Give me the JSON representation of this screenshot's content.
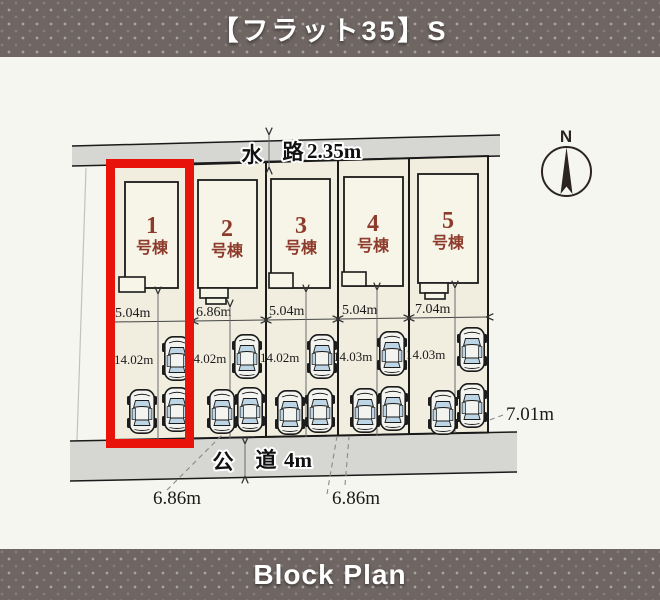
{
  "header": {
    "title": "【フラット35】S"
  },
  "footer": {
    "title": "Block Plan"
  },
  "compass": {
    "north_label": "N"
  },
  "waterway": {
    "label_left": "水",
    "label_right": "路",
    "dimension": "2.35m"
  },
  "road": {
    "label_left": "公",
    "label_right": "道",
    "dimension": "4m"
  },
  "lots": [
    {
      "number": "1",
      "suffix": "号棟",
      "width": "5.04m",
      "depth": "14.02m",
      "highlighted": true
    },
    {
      "number": "2",
      "suffix": "号棟",
      "width": "6.86m",
      "depth": "14.02m",
      "highlighted": false
    },
    {
      "number": "3",
      "suffix": "号棟",
      "width": "5.04m",
      "depth": "14.02m",
      "highlighted": false
    },
    {
      "number": "4",
      "suffix": "号棟",
      "width": "5.04m",
      "depth": "14.03m",
      "highlighted": false
    },
    {
      "number": "5",
      "suffix": "号棟",
      "width": "7.04m",
      "depth": "14.03m",
      "highlighted": false
    }
  ],
  "frontage_labels": [
    "6.86m",
    "6.86m"
  ],
  "side_dimension": "7.01m",
  "colors": {
    "banner_bg": "#6f6663",
    "banner_text": "#ffffff",
    "plan_bg": "#f5f6f0",
    "band_fill": "#d6d6d2",
    "lot_fill": "#f1eee0",
    "house_fill": "#f7f4e8",
    "lot_number": "#8d3b2b",
    "highlight": "#e8140c",
    "car_glass": "#bdd5e4"
  }
}
